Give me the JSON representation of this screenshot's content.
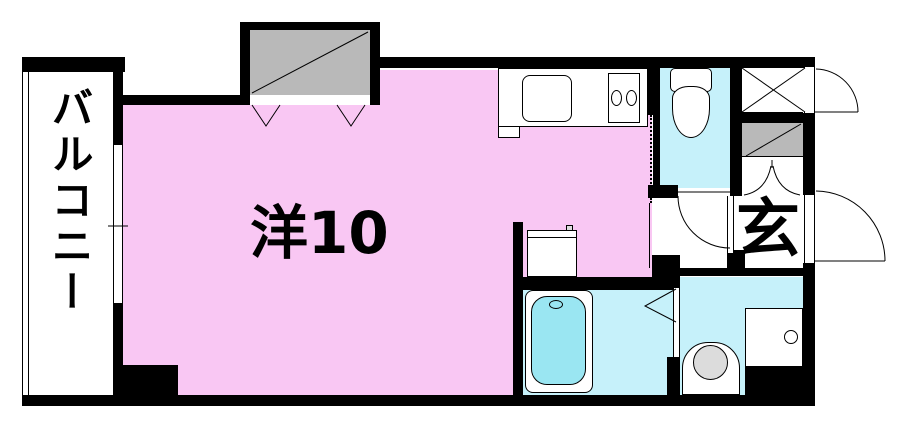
{
  "floor_plan": {
    "rooms": {
      "balcony": {
        "label": "バルコニー"
      },
      "main_room": {
        "label": "洋10"
      },
      "entrance": {
        "label": "玄"
      }
    },
    "colors": {
      "room_pink": "#F9C7F3",
      "wet_area_cyan": "#C6F1FA",
      "bathtub_cyan": "#9AE6F2",
      "storage_gray": "#B9B9B9",
      "appliance_gray": "#DCDCDC",
      "wall_black": "#000000"
    }
  }
}
